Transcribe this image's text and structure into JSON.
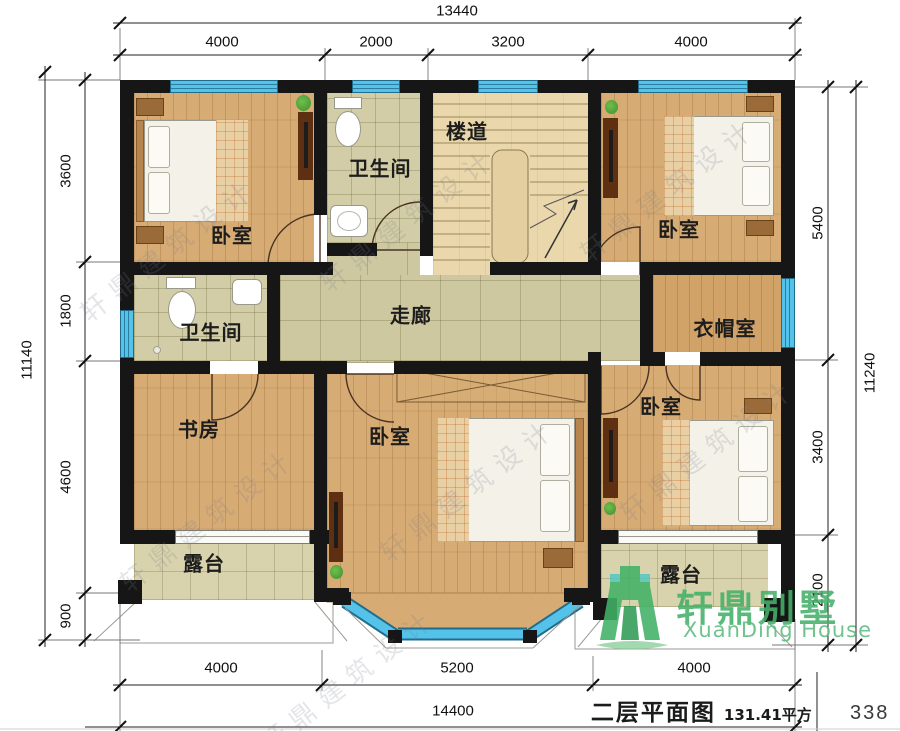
{
  "dimensions": {
    "top_total": "13440",
    "top_segments": [
      "4000",
      "2000",
      "3200",
      "4000"
    ],
    "left_total": "11140",
    "left_segments": [
      "3600",
      "1800",
      "4600",
      "900"
    ],
    "right_total": "11240",
    "right_segments": [
      "5400",
      "3400",
      "2100"
    ],
    "bottom_segments": [
      "4000",
      "5200",
      "4000"
    ],
    "bottom_total": "14400"
  },
  "rooms": {
    "bedroom_tl": "卧室",
    "bathroom_top": "卫生间",
    "stairhall": "楼道",
    "bedroom_tr": "卧室",
    "bathroom_left": "卫生间",
    "corridor": "走廊",
    "cloakroom": "衣帽室",
    "study": "书房",
    "bedroom_center": "卧室",
    "bedroom_br": "卧室",
    "terrace_left": "露台",
    "terrace_right": "露台"
  },
  "footer": {
    "title": "二层平面图",
    "area": "131.41平方",
    "page": "338"
  },
  "logo": {
    "name": "轩鼎别墅",
    "subtitle": "XuanDing House"
  },
  "watermark": {
    "text": "轩鼎建筑设计"
  },
  "colors": {
    "wall": "#161616",
    "window_blue": "#55C2EA",
    "wood": "#D7AB74",
    "tile": "#CFC9A2",
    "logo_green": "#45B06A"
  }
}
